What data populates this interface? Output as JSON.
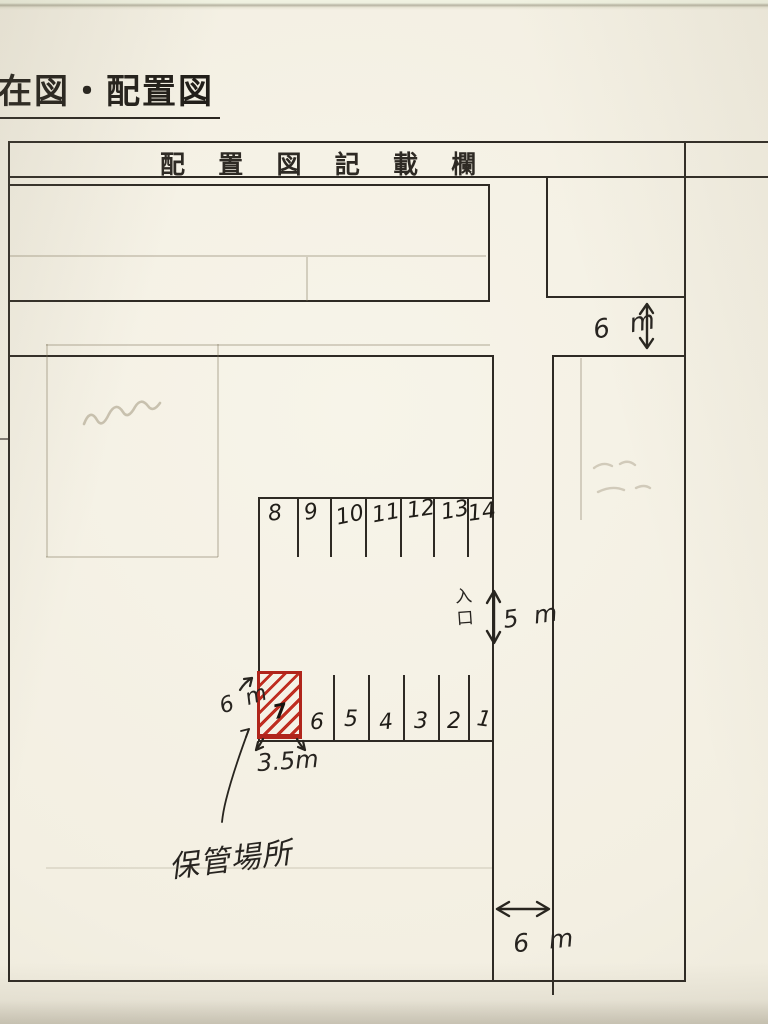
{
  "page": {
    "title": "在図・配置図",
    "header": "配 置 図 記 載 欄"
  },
  "labels": {
    "storage_location": "保管場所",
    "entrance": "入口"
  },
  "dimensions": {
    "top_road_width": "6 m",
    "aisle_width": "5 m",
    "stall_depth": "6 m",
    "stall_width": "3.5m",
    "bottom_road_width": "6 m"
  },
  "parking": {
    "top_row": [
      "8",
      "9",
      "10",
      "11",
      "12",
      "13",
      "14"
    ],
    "bottom_row": [
      "7",
      "6",
      "5",
      "4",
      "3",
      "2",
      "1"
    ],
    "highlighted_stall": "7"
  },
  "colors": {
    "ink": "#2e2a24",
    "highlight_red": "#b0251b",
    "paper": "#f3efe2",
    "pencil_ghost": "#7a7056"
  }
}
